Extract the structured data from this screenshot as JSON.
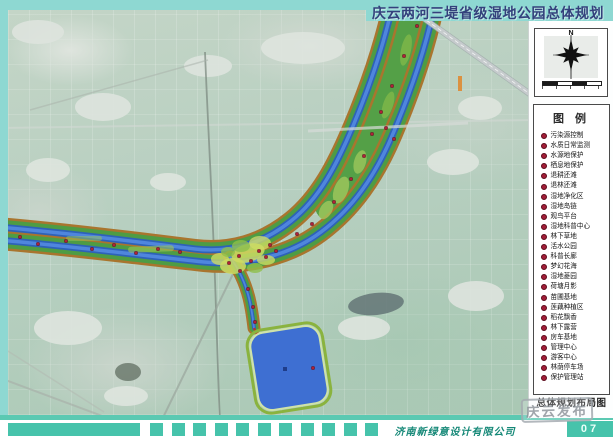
{
  "header": {
    "title": "庆云两河三堤省级湿地公园总体规划"
  },
  "compass": {
    "north_label": "N"
  },
  "legend": {
    "title": "图 例",
    "items": [
      "污染源控制",
      "水质日常监测",
      "水源地保护",
      "栖息地保护",
      "退耕还滩",
      "退林还滩",
      "湿地净化区",
      "湿地岛链",
      "观鸟平台",
      "湿地科普中心",
      "林下草地",
      "活水公园",
      "科普长廊",
      "梦幻花海",
      "湿地菱园",
      "荷塘月影",
      "苗圃基地",
      "莲藕种植区",
      "稻花飘香",
      "林下露营",
      "房车基地",
      "管理中心",
      "游客中心",
      "林荫停车场",
      "保护管理站"
    ]
  },
  "panel": {
    "caption": "总体规划布局图"
  },
  "footer": {
    "company": "济南新绿意设计有限公司",
    "page_number": "07"
  },
  "watermark": {
    "text": "庆云发布"
  },
  "colors": {
    "frame_cyan": "#8ed8d2",
    "band_teal": "#46c3ab",
    "title_text": "#33417c",
    "legend_bullet": "#a11d37",
    "river_blue": "#3e6fd2",
    "corridor_green": "#4e9c44",
    "dike_brown": "#a9752e",
    "marker_red": "#b02038"
  }
}
